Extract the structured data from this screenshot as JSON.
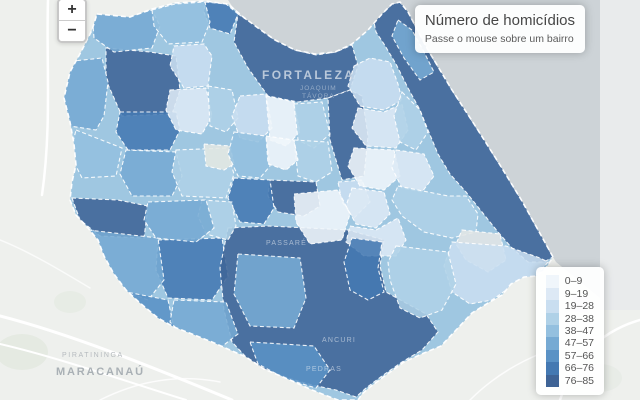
{
  "controls": {
    "zoom_in": "+",
    "zoom_out": "−"
  },
  "info_box": {
    "title": "Número de homicídios",
    "subtitle": "Passe o mouse sobre um bairro"
  },
  "legend": {
    "items": [
      {
        "label": "0–9",
        "color": "c1"
      },
      {
        "label": "9–19",
        "color": "c2"
      },
      {
        "label": "19–28",
        "color": "c3"
      },
      {
        "label": "28–38",
        "color": "c4"
      },
      {
        "label": "38–47",
        "color": "c5"
      },
      {
        "label": "47–57",
        "color": "c6"
      },
      {
        "label": "57–66",
        "color": "c7"
      },
      {
        "label": "66–76",
        "color": "c8"
      },
      {
        "label": "76–85",
        "color": "c9"
      }
    ]
  },
  "map": {
    "palette": {
      "c1": "#f0f6fb",
      "c2": "#dde9f5",
      "c3": "#c9def0",
      "c4": "#afd1e7",
      "c5": "#94c0df",
      "c6": "#76aad3",
      "c7": "#5a92c5",
      "c8": "#4479b2",
      "c9": "#3f6496",
      "base": "#e3e7e2",
      "base2": "#e2e6e6"
    },
    "colors": {
      "water": "#cdd3d7",
      "land": "#eef0ed",
      "tile_gap": "#e9ebec"
    },
    "water_points": "228,0 600,0 600,298 556,262 553,257 542,237 522,201 500,165 476,127 452,90 428,50 408,12 400,2 392,4 382,14 368,30 352,44 335,52 315,54 295,50 275,40 258,28 242,16 232,6",
    "tile_gap_rect": {
      "x": 600,
      "y": 0,
      "w": 40,
      "h": 310
    },
    "outline": "97,14 130,17 152,9 175,3 205,1 228,4 242,16 258,28 275,40 295,50 315,54 335,52 352,44 368,30 382,14 392,4 400,2 408,12 428,50 452,90 476,127 500,165 522,201 542,237 553,257 546,268 537,276 524,277 511,284 502,295 488,303 472,313 457,329 441,346 424,353 404,362 386,375 370,387 362,394 358,400 338,400 330,397 312,390 290,380 264,369 246,357 230,350 212,342 192,334 174,327 158,318 140,303 126,290 114,274 104,256 98,240 88,228 76,215 70,200 72,182 76,165 74,144 70,122 64,98 70,72 82,50 92,30",
    "backing_color": "c5",
    "regions": [
      {
        "points": "238,14 256,26 275,40 295,50 316,55 336,52 352,45 358,66 350,90 328,98 298,102 268,96 248,68 234,42",
        "color": "c9"
      },
      {
        "points": "106,48 150,52 176,56 180,90 172,114 122,116 106,80",
        "color": "c9"
      },
      {
        "points": "328,98 350,90 362,96 368,136 364,176 342,180 330,140",
        "color": "c9"
      },
      {
        "points": "270,180 316,182 320,206 304,216 278,212 268,196",
        "color": "c9"
      },
      {
        "points": "234,178 270,180 274,208 264,224 240,222 228,198",
        "color": "c8"
      },
      {
        "points": "205,2 226,4 238,14 230,34 210,28 204,12",
        "color": "c8"
      },
      {
        "points": "120,112 176,112 180,130 170,150 128,150 116,132",
        "color": "c8"
      },
      {
        "points": "72,198 118,200 148,206 144,238 100,236 80,220",
        "color": "c9"
      },
      {
        "points": "158,240 222,238 228,276 212,300 168,298 156,270",
        "color": "c8"
      },
      {
        "points": "228,228 268,226 308,228 348,230 384,240 380,266 386,292 404,302 426,314 438,332 422,350 402,362 382,376 366,388 356,397 336,390 312,385 288,378 264,369 246,357 232,342 224,310 220,268",
        "color": "c9"
      },
      {
        "points": "374,22 386,10 392,4 400,2 408,12 428,50 452,90 476,127 500,165 522,201 542,237 553,257 544,262 528,262 512,248 498,232 482,212 466,192 450,174 438,154 428,130 420,110 408,88 396,64 384,44 376,32",
        "color": "c9"
      },
      {
        "points": "92,12 130,16 152,10 160,26 152,48 114,52 94,38",
        "color": "c6"
      },
      {
        "points": "152,10 175,4 205,2 210,22 202,42 168,44 154,26",
        "color": "c5"
      },
      {
        "points": "174,46 204,44 212,56 208,86 184,88 170,66",
        "color": "c3"
      },
      {
        "points": "170,90 206,88 212,116 202,134 176,130 166,110",
        "color": "c2"
      },
      {
        "points": "208,86 232,90 238,118 226,132 210,126",
        "color": "c4"
      },
      {
        "points": "240,96 266,94 272,128 258,142 240,138 232,116",
        "color": "c3"
      },
      {
        "points": "266,96 294,102 300,132 286,146 270,140",
        "color": "c1"
      },
      {
        "points": "294,104 322,102 330,134 314,148 298,140",
        "color": "c4"
      },
      {
        "points": "64,62 102,58 108,82 104,116 96,130 70,126 60,96",
        "color": "c6"
      },
      {
        "points": "76,130 122,148 116,176 82,178 70,154",
        "color": "c5"
      },
      {
        "points": "126,150 176,152 182,176 172,196 132,196 120,174",
        "color": "c6"
      },
      {
        "points": "176,150 226,148 234,174 226,198 182,196 172,172",
        "color": "c4"
      },
      {
        "points": "202,200 232,202 236,226 228,240 206,234 198,216",
        "color": "c4"
      },
      {
        "points": "204,144 230,146 234,164 224,170 206,166",
        "color": "base"
      },
      {
        "points": "234,132 266,136 270,166 260,178 238,176 228,154",
        "color": "c5"
      },
      {
        "points": "294,140 328,142 332,172 316,182 298,176",
        "color": "c4"
      },
      {
        "points": "338,182 362,180 370,202 354,218 342,202",
        "color": "c3"
      },
      {
        "points": "354,66 370,58 390,62 398,84 402,100 384,110 360,106 348,86",
        "color": "c3"
      },
      {
        "points": "358,108 384,112 402,104 408,130 396,148 366,146 352,128",
        "color": "c2"
      },
      {
        "points": "402,92 420,110 428,132 416,150 400,142 394,116",
        "color": "c4"
      },
      {
        "points": "354,148 394,150 400,176 384,190 360,186 348,166",
        "color": "c1"
      },
      {
        "points": "396,150 424,154 434,176 422,192 402,188 392,168",
        "color": "c2"
      },
      {
        "points": "352,188 384,192 390,214 376,228 356,224 346,206",
        "color": "c2"
      },
      {
        "points": "350,226 376,230 398,218 406,240 396,256 364,256 346,242",
        "color": "c2"
      },
      {
        "points": "398,20 412,30 424,52 434,72 420,80 404,58 392,36",
        "color": "c6"
      },
      {
        "points": "398,186 428,192 448,196 466,196 478,214 476,232 452,238 424,232 402,216 392,200",
        "color": "c4"
      },
      {
        "points": "462,230 500,234 506,260 488,272 466,260 456,244",
        "color": "base2"
      },
      {
        "points": "452,242 506,246 540,258 548,262 536,276 512,286 492,300 470,304 452,292 444,266",
        "color": "c3"
      },
      {
        "points": "396,246 448,252 456,284 442,310 420,318 400,308 390,280 388,262",
        "color": "c4"
      },
      {
        "points": "238,254 300,258 306,298 294,328 250,326 234,294",
        "color": "c6"
      },
      {
        "points": "250,342 314,346 330,370 316,388 286,379 258,364",
        "color": "c7"
      },
      {
        "points": "352,238 382,242 378,268 384,292 368,300 350,290 344,262",
        "color": "c8"
      },
      {
        "points": "88,230 158,238 164,280 148,300 116,288 96,260",
        "color": "c6"
      },
      {
        "points": "116,290 168,300 174,328 156,336 130,318",
        "color": "c7"
      },
      {
        "points": "174,300 226,302 238,334 220,348 186,338 170,322",
        "color": "c6"
      },
      {
        "points": "148,202 206,200 214,228 196,242 156,238 144,220",
        "color": "c6"
      },
      {
        "points": "266,136 294,140 298,160 286,170 268,164",
        "color": "c1"
      },
      {
        "points": "294,194 338,190 350,214 342,240 310,244 296,222",
        "color": "c1"
      }
    ],
    "labels": [
      {
        "text": "PIRATININGA",
        "x": 62,
        "y": 357,
        "size": 7,
        "ls": 1.6,
        "color": "#b5babe",
        "bold": false
      },
      {
        "text": "MARACANAÚ",
        "x": 56,
        "y": 375,
        "size": 11,
        "ls": 1.8,
        "color": "#a9b0b5",
        "bold": true
      },
      {
        "text": "FORTALEZA",
        "x": 262,
        "y": 79,
        "size": 12,
        "ls": 2.4,
        "color": "rgba(205,215,228,0.85)",
        "bold": true
      },
      {
        "text": "JOAQUIM",
        "x": 300,
        "y": 90,
        "size": 6.5,
        "ls": 1,
        "color": "rgba(220,228,236,0.5)",
        "bold": false
      },
      {
        "text": "TÁVORA",
        "x": 302,
        "y": 98,
        "size": 6.5,
        "ls": 1,
        "color": "rgba(220,228,236,0.5)",
        "bold": false
      },
      {
        "text": "PASSARÉ",
        "x": 266,
        "y": 245,
        "size": 7,
        "ls": 1.2,
        "color": "rgba(255,255,255,0.5)",
        "bold": false
      },
      {
        "text": "ANCURI",
        "x": 322,
        "y": 342,
        "size": 7,
        "ls": 1.2,
        "color": "rgba(255,255,255,0.5)",
        "bold": false
      },
      {
        "text": "PEDRAS",
        "x": 306,
        "y": 371,
        "size": 7,
        "ls": 1.2,
        "color": "rgba(255,255,255,0.5)",
        "bold": false
      }
    ]
  }
}
